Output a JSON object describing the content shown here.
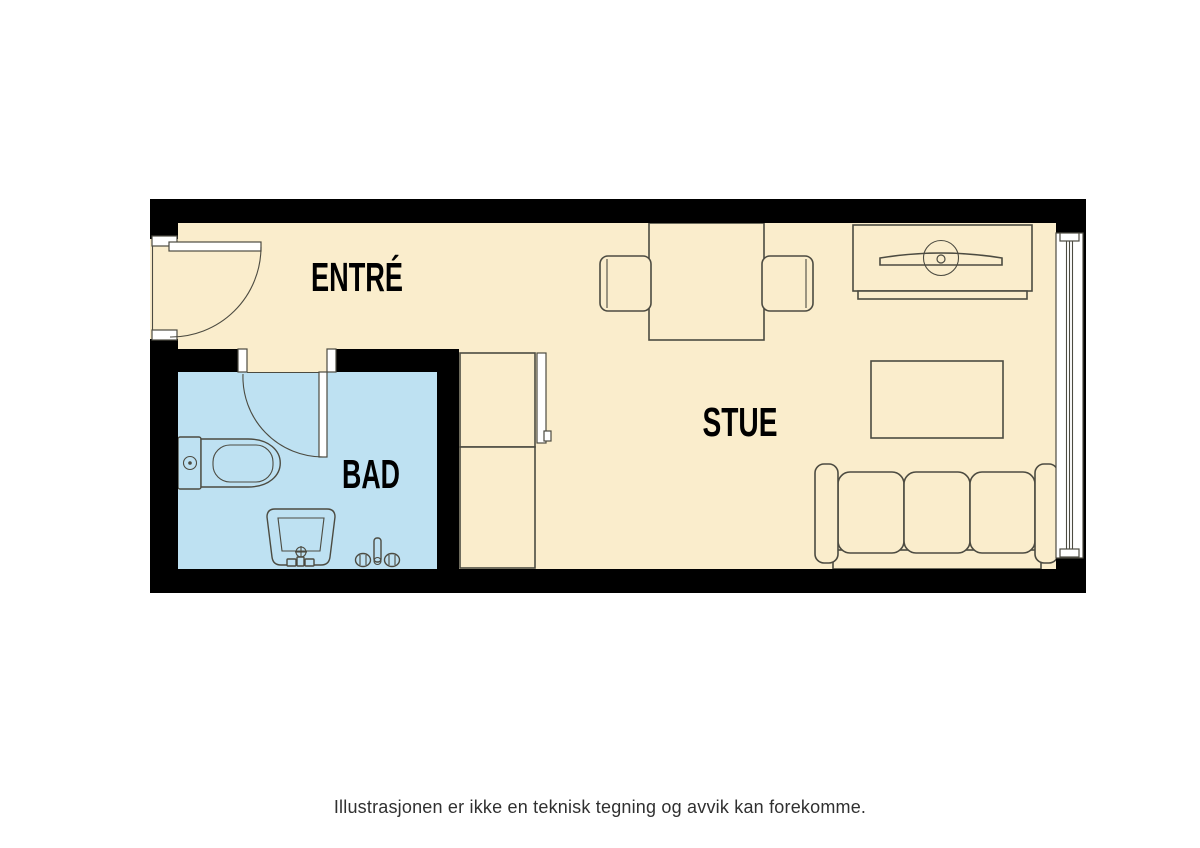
{
  "rooms": {
    "entre": "ENTRÉ",
    "bad": "BAD",
    "stue": "STUE"
  },
  "caption": "Illustrasjonen er ikke en teknisk tegning og avvik kan forekomme.",
  "colors": {
    "background": "#FFFFFF",
    "floor": "#FAEDCC",
    "bathroom": "#BEE1F2",
    "wall": "#000000",
    "line": "#4C4B41",
    "label": "#000000",
    "caption": "#303030",
    "door": "#FFFFFF"
  },
  "furniture": [
    "entrance-door",
    "bathroom-door",
    "toilet",
    "sink",
    "shower-mixer",
    "wardrobe",
    "dining-table",
    "dining-chair",
    "dining-chair",
    "tv-bench",
    "tv",
    "coffee-table",
    "sofa",
    "window"
  ]
}
